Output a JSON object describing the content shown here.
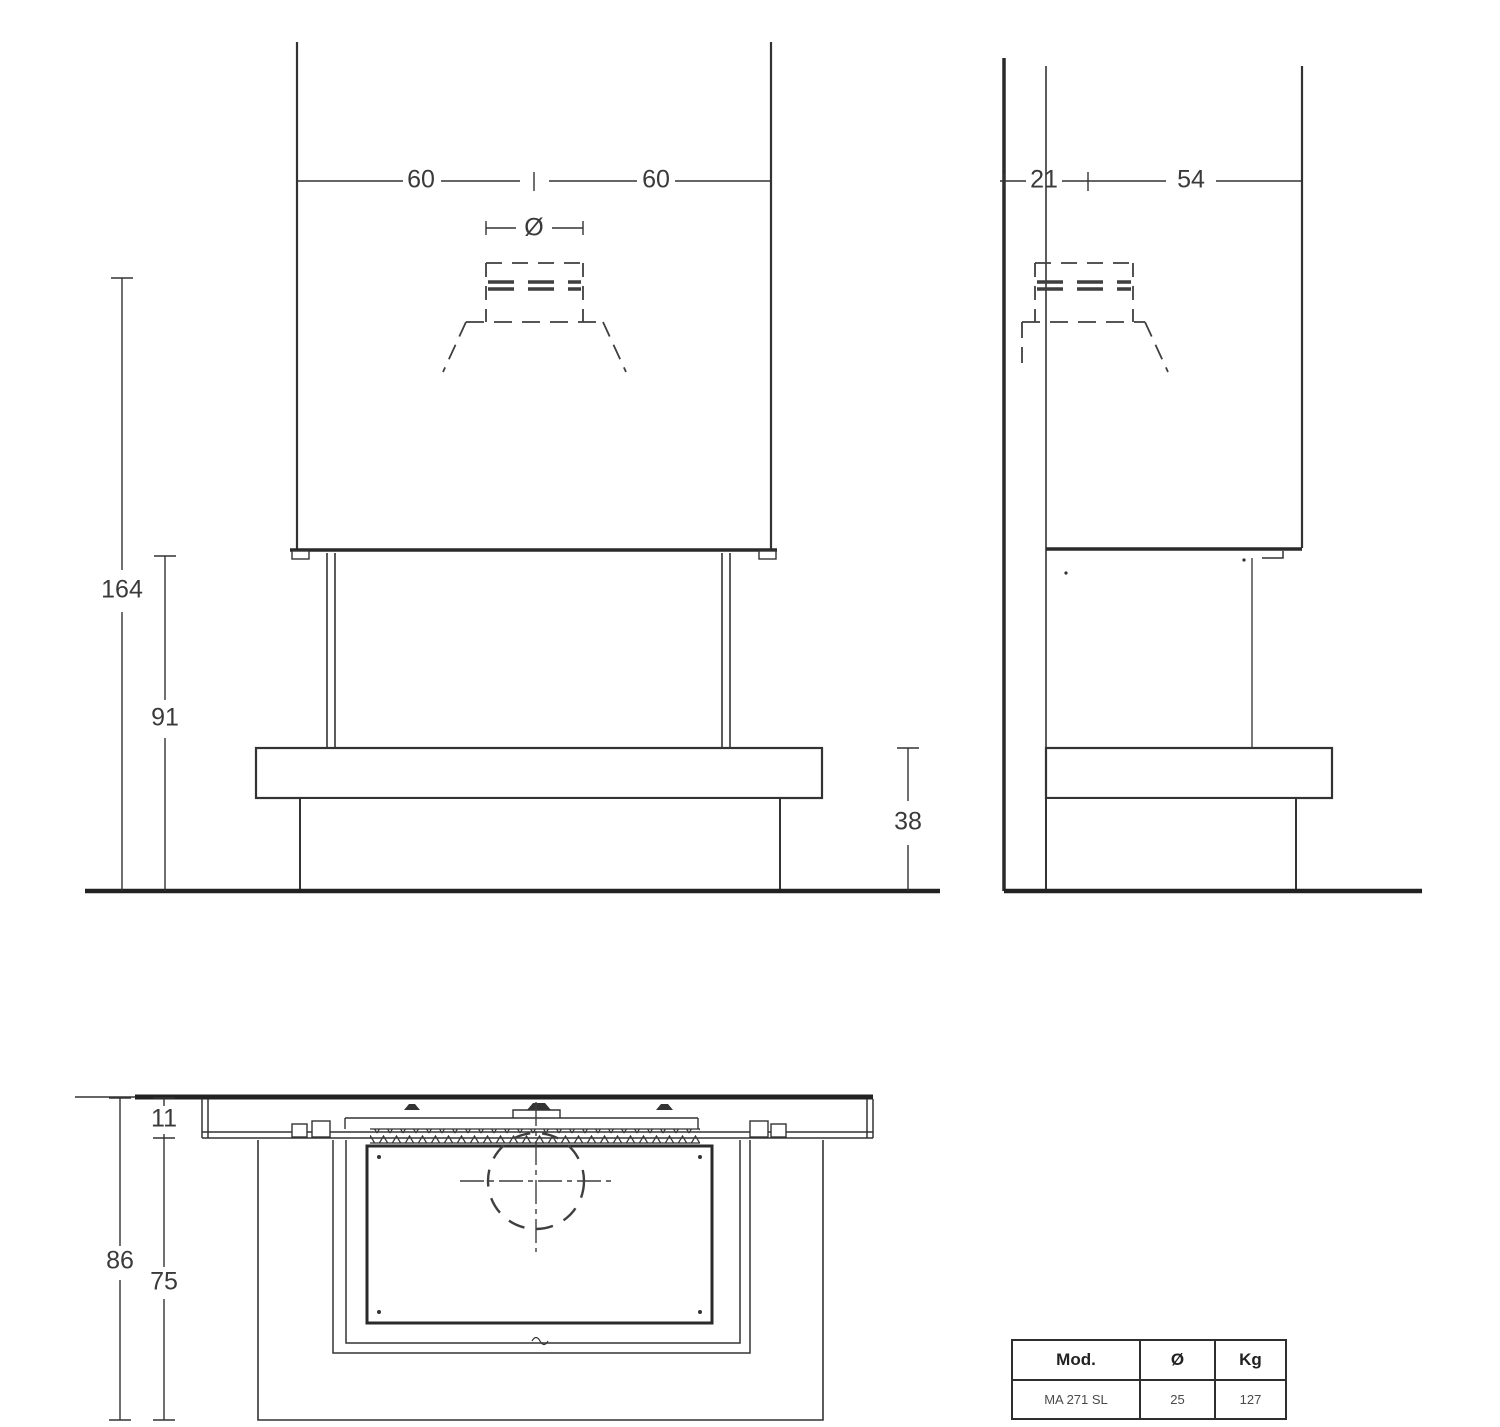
{
  "drawing": {
    "front_view": {
      "dims": {
        "width_left": "60",
        "width_right": "60",
        "flue_diameter": "Ø",
        "total_height": "164",
        "opening_height": "91",
        "bench_height": "38"
      }
    },
    "side_view": {
      "dims": {
        "flue_offset": "21",
        "depth": "54"
      }
    },
    "plan_view": {
      "dims": {
        "top_thickness": "11",
        "total_depth": "86",
        "inner_depth": "75"
      }
    }
  },
  "spec_table": {
    "headers": [
      "Mod.",
      "Ø",
      "Kg"
    ],
    "rows": [
      [
        "MA 271 SL",
        "25",
        "127"
      ]
    ]
  }
}
